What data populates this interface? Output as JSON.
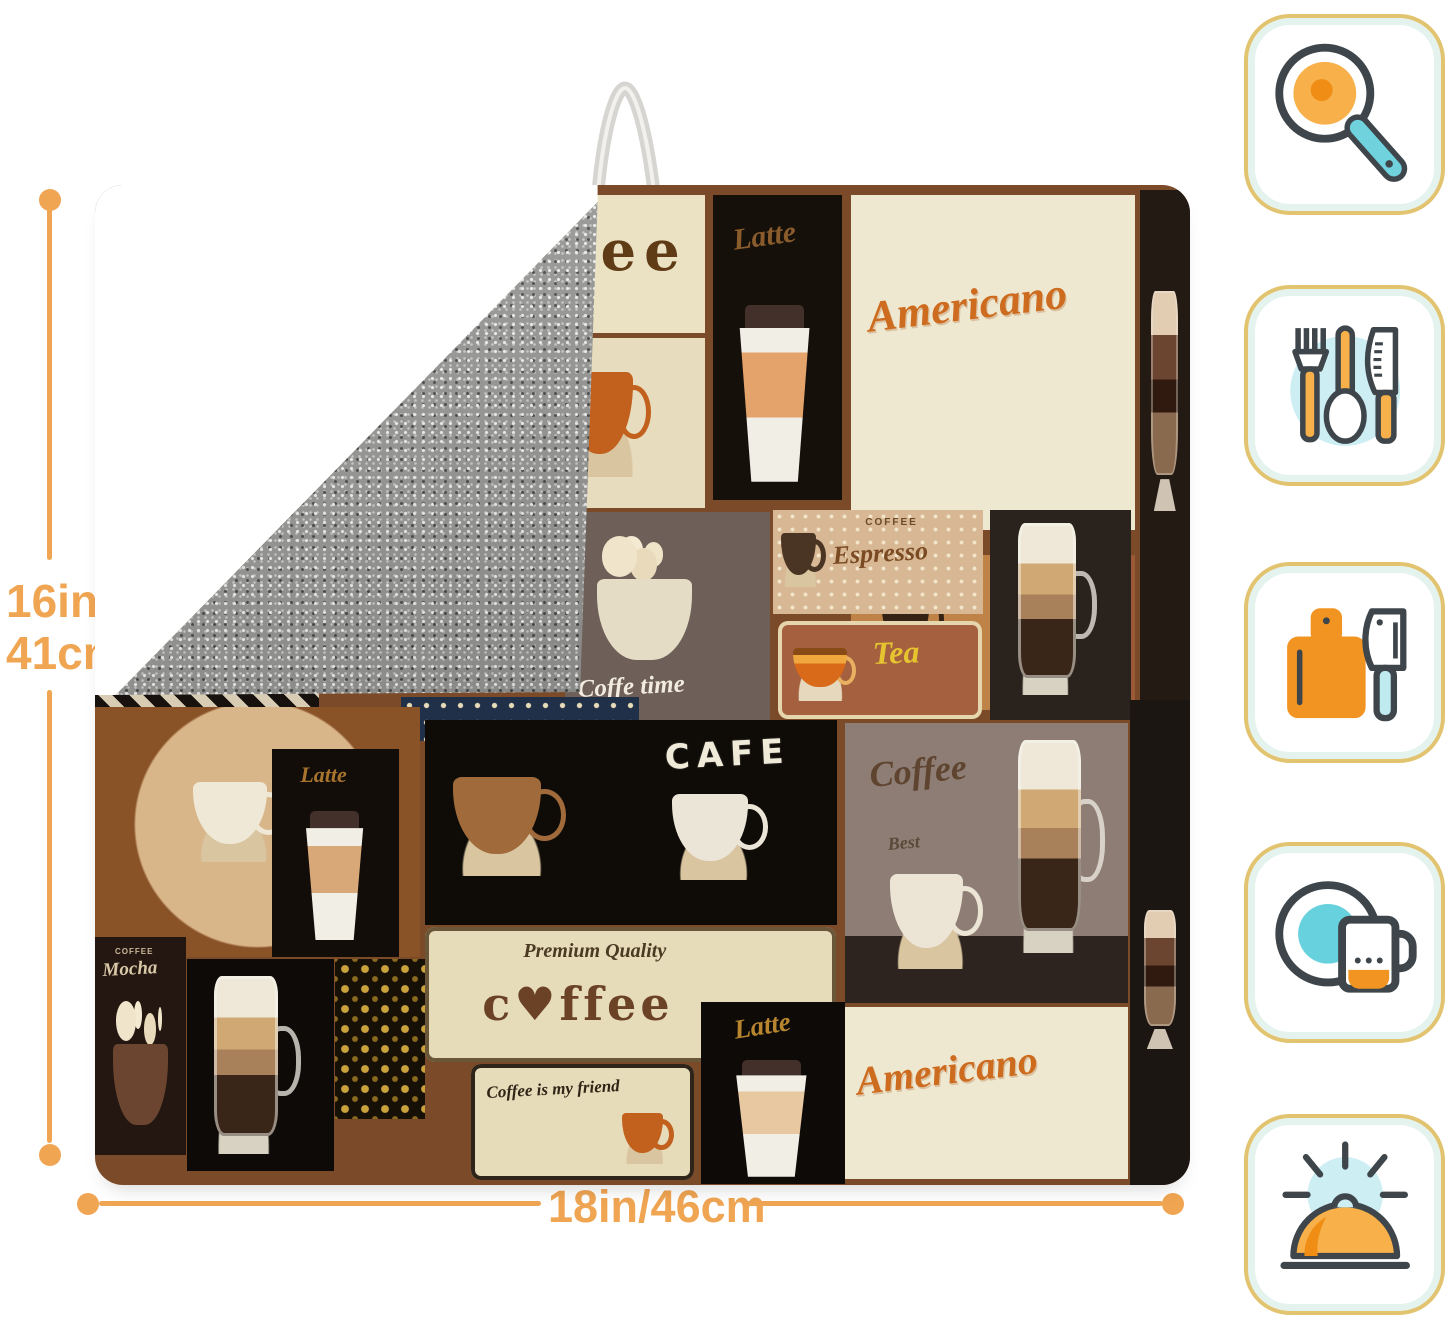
{
  "background": "#ffffff",
  "accent_color": "#f0a552",
  "dimensions": {
    "height_line1": "16in/",
    "height_line2": "41cm",
    "width_label": "18in/46cm"
  },
  "icon_palette": {
    "card_border": "#e2c36f",
    "card_glow": "#e4f3ee",
    "orange": "#f7b04a",
    "orange_dark": "#ef8d14",
    "teal": "#6fd2dd",
    "pale_teal": "#cdeef3",
    "outline": "#3e464b"
  },
  "icons": [
    {
      "name": "frying-pan-icon"
    },
    {
      "name": "cutlery-icon"
    },
    {
      "name": "cutting-board-icon"
    },
    {
      "name": "plate-mug-icon"
    },
    {
      "name": "serving-cloche-icon"
    }
  ],
  "product": {
    "type": "coffee collage dish drying mat",
    "base_color": "#7b4a28",
    "backing_color": "#90908e",
    "loop_color": "#d6d5d1",
    "tiles": [
      {
        "name": "coffee-wordmark",
        "x": 5,
        "y": 1,
        "w": 50.7,
        "h": 13.8,
        "bg": "#ebe2c4",
        "labels": [
          {
            "text": "Coffee",
            "x": 52,
            "y": 20,
            "size": 56,
            "color": "#5f3b16",
            "style": "beans",
            "ls": 8
          }
        ]
      },
      {
        "name": "steaming-cup",
        "x": 13.5,
        "y": 15.3,
        "w": 42.2,
        "h": 17,
        "bg": "#e8dcbe",
        "arts": [
          {
            "type": "cup",
            "color": "#c2601d",
            "x": 70,
            "y": 20,
            "w": 19,
            "h": 62
          }
        ]
      },
      {
        "name": "latte-togo",
        "x": 56.4,
        "y": 1,
        "w": 11.8,
        "h": 30.5,
        "bg": "#16100b",
        "labels": [
          {
            "text": "Latte",
            "x": 14,
            "y": 10,
            "size": 30,
            "color": "#8a5c2c",
            "style": "script",
            "rot": -8
          }
        ],
        "arts": [
          {
            "type": "togo",
            "color": "#e3a36b",
            "x": 18,
            "y": 36,
            "w": 60,
            "h": 58
          }
        ]
      },
      {
        "name": "americano-top",
        "x": 69,
        "y": 1,
        "w": 26,
        "h": 33.5,
        "bg": "#efe8d0",
        "labels": [
          {
            "text": "Americano",
            "x": 5,
            "y": 30,
            "size": 44,
            "color": "#cd6b1f",
            "style": "brush",
            "rot": -7
          }
        ]
      },
      {
        "name": "espresso-glass",
        "x": 69,
        "y": 37,
        "w": 12.8,
        "h": 15.5,
        "bg": "#bf8347",
        "arts": [
          {
            "type": "cup",
            "color": "#342215",
            "x": 22,
            "y": 20,
            "w": 46,
            "h": 55
          }
        ]
      },
      {
        "name": "hot-fresh",
        "x": 82.1,
        "y": 37,
        "w": 12.9,
        "h": 16.5,
        "bg": "#9a5a38",
        "labels": [
          {
            "text": "Coffee",
            "x": 20,
            "y": 6,
            "size": 20,
            "color": "#3d2414",
            "style": "script"
          },
          {
            "text": "hot fresh",
            "x": 12,
            "y": 80,
            "size": 16,
            "color": "#efe2c8",
            "style": "script"
          }
        ],
        "arts": [
          {
            "type": "cup",
            "color": "#ece4d4",
            "x": 26,
            "y": 32,
            "w": 40,
            "h": 40
          }
        ]
      },
      {
        "name": "parfait-strip-top",
        "x": 95.4,
        "y": 0.5,
        "w": 4.6,
        "h": 51,
        "bg": "#241a14",
        "arts": [
          {
            "type": "parfait",
            "color": "#c9a27a",
            "x": 8,
            "y": 18,
            "w": 84,
            "h": 45
          }
        ]
      },
      {
        "name": "coffee-time",
        "x": 42.9,
        "y": 32.7,
        "w": 18.7,
        "h": 21.7,
        "bg": "#6e6058",
        "labels": [
          {
            "text": "Coffe time",
            "x": 6,
            "y": 76,
            "size": 25,
            "color": "#f2ece0",
            "style": "script",
            "rot": -3
          }
        ],
        "arts": [
          {
            "type": "whipped",
            "color": "#e5dcc6",
            "x": 10,
            "y": 10,
            "w": 58,
            "h": 62
          }
        ]
      },
      {
        "name": "espresso-sign",
        "x": 61.9,
        "y": 32.5,
        "w": 19.2,
        "h": 10.4,
        "bg": "#d8b894",
        "pattern": "polka",
        "labels": [
          {
            "text": "COFFEE",
            "x": 44,
            "y": 8,
            "size": 10,
            "color": "#6b4a28",
            "style": "plain",
            "ls": 2
          },
          {
            "text": "Espresso",
            "x": 28,
            "y": 32,
            "size": 26,
            "color": "#7a4a22",
            "style": "script",
            "rot": -3
          }
        ],
        "arts": [
          {
            "type": "cup",
            "color": "#4a3424",
            "x": 4,
            "y": 22,
            "w": 22,
            "h": 52
          }
        ]
      },
      {
        "name": "tea-sign",
        "x": 62.4,
        "y": 43.6,
        "w": 18.6,
        "h": 9.8,
        "bg": "#a5613f",
        "frame": "#e5d6ae",
        "labels": [
          {
            "text": "Tea",
            "x": 46,
            "y": 16,
            "size": 32,
            "color": "#e6c430",
            "style": "script",
            "rot": -2
          }
        ],
        "arts": [
          {
            "type": "teabowl",
            "color": "#e07818",
            "x": 6,
            "y": 16,
            "w": 32,
            "h": 66
          }
        ]
      },
      {
        "name": "latte-glass-mid",
        "x": 81.7,
        "y": 32.5,
        "w": 12.9,
        "h": 21,
        "bg": "#2a221c",
        "arts": [
          {
            "type": "glassmug",
            "color": "#c9a06a",
            "x": 18,
            "y": 6,
            "w": 58,
            "h": 82
          }
        ]
      },
      {
        "name": "bw-diamond-strip",
        "x": 0,
        "y": 50,
        "w": 20.5,
        "h": 3.8,
        "bg": "#17120e",
        "pattern": "diamond-bw"
      },
      {
        "name": "blue-diamond-strip",
        "x": 27.9,
        "y": 51.2,
        "w": 21.8,
        "h": 4.4,
        "bg": "#203049",
        "pattern": "dots-cream"
      },
      {
        "name": "cup-medallion",
        "x": 0,
        "y": 52.2,
        "w": 29.7,
        "h": 25,
        "bg": "#8a5227",
        "pattern": "medallion",
        "arts": [
          {
            "type": "cup",
            "color": "#efe8d6",
            "x": 30,
            "y": 30,
            "w": 30,
            "h": 32
          }
        ]
      },
      {
        "name": "latte-small",
        "x": 16.2,
        "y": 56.4,
        "w": 11.6,
        "h": 20.8,
        "bg": "#120d09",
        "labels": [
          {
            "text": "Latte",
            "x": 22,
            "y": 7,
            "size": 22,
            "color": "#a8742e",
            "style": "script"
          }
        ],
        "arts": [
          {
            "type": "togo",
            "color": "#d8a878",
            "x": 24,
            "y": 30,
            "w": 50,
            "h": 62
          }
        ]
      },
      {
        "name": "cafe-board",
        "x": 30.1,
        "y": 53.5,
        "w": 37.7,
        "h": 20.5,
        "bg": "#0f0c08",
        "labels": [
          {
            "text": "CAFE",
            "x": 58,
            "y": 10,
            "size": 34,
            "color": "#f0ead8",
            "style": "chalk",
            "ls": 7,
            "rot": -3
          }
        ],
        "arts": [
          {
            "type": "cup",
            "color": "#a06a3a",
            "x": 7,
            "y": 28,
            "w": 28,
            "h": 48
          },
          {
            "type": "cup",
            "color": "#ebe5d7",
            "x": 60,
            "y": 36,
            "w": 24,
            "h": 42
          }
        ]
      },
      {
        "name": "premium-quality",
        "x": 30.1,
        "y": 74.2,
        "w": 37.6,
        "h": 13.5,
        "bg": "#e6dcba",
        "frame": "#6a5638",
        "labels": [
          {
            "text": "Premium Quality",
            "x": 24,
            "y": 10,
            "size": 20,
            "color": "#4a3a22",
            "style": "script"
          },
          {
            "text": "c♥ffee",
            "x": 14,
            "y": 40,
            "size": 46,
            "color": "#6b4226",
            "style": "beans",
            "ls": 4
          }
        ]
      },
      {
        "name": "gold-ornament",
        "x": 21.9,
        "y": 77.4,
        "w": 8.2,
        "h": 16,
        "bg": "#171007",
        "pattern": "gold"
      },
      {
        "name": "mocha",
        "x": 0,
        "y": 75.2,
        "w": 8.3,
        "h": 21.8,
        "bg": "#241711",
        "labels": [
          {
            "text": "COFFEE",
            "x": 22,
            "y": 5,
            "size": 8,
            "color": "#cbb89a",
            "style": "plain",
            "ls": 1
          },
          {
            "text": "Mocha",
            "x": 8,
            "y": 11,
            "size": 19,
            "color": "#d8c8a8",
            "style": "script",
            "rot": -3
          }
        ],
        "arts": [
          {
            "type": "whipped",
            "color": "#6b4530",
            "x": 12,
            "y": 28,
            "w": 76,
            "h": 62
          }
        ]
      },
      {
        "name": "latte-glass-bottomleft",
        "x": 8.4,
        "y": 77.4,
        "w": 13.4,
        "h": 21.2,
        "bg": "#0d0a07",
        "arts": [
          {
            "type": "glassmug",
            "color": "#c9a06a",
            "x": 16,
            "y": 8,
            "w": 62,
            "h": 84
          }
        ]
      },
      {
        "name": "coffee-friend",
        "x": 34.3,
        "y": 87.9,
        "w": 20.4,
        "h": 11.6,
        "bg": "#e6dcba",
        "frame": "#2e241a",
        "labels": [
          {
            "text": "Coffee is my friend",
            "x": 7,
            "y": 16,
            "size": 17,
            "color": "#2f2416",
            "style": "script",
            "rot": -3,
            "w": 62
          }
        ],
        "arts": [
          {
            "type": "cup",
            "color": "#c2601d",
            "x": 68,
            "y": 42,
            "w": 24,
            "h": 44
          }
        ]
      },
      {
        "name": "latte-gold",
        "x": 55.3,
        "y": 81.7,
        "w": 13.2,
        "h": 18.2,
        "bg": "#0d0a07",
        "labels": [
          {
            "text": "Latte",
            "x": 22,
            "y": 8,
            "size": 27,
            "color": "#b8862e",
            "style": "script",
            "rot": -9
          }
        ],
        "arts": [
          {
            "type": "togo",
            "color": "#e8c8a0",
            "x": 22,
            "y": 32,
            "w": 54,
            "h": 64
          }
        ]
      },
      {
        "name": "coffee-best",
        "x": 68.5,
        "y": 53.8,
        "w": 25.8,
        "h": 28,
        "bg": "#8d7d74",
        "pattern": "duotone",
        "labels": [
          {
            "text": "Coffee",
            "x": 8,
            "y": 12,
            "size": 36,
            "color": "#5f4430",
            "style": "script",
            "rot": -5
          },
          {
            "text": "Best",
            "x": 15,
            "y": 40,
            "size": 18,
            "color": "#5a4a3a",
            "style": "script",
            "rot": -5
          }
        ],
        "arts": [
          {
            "type": "glassmug",
            "color": "#c9a06a",
            "x": 60,
            "y": 6,
            "w": 32,
            "h": 76
          },
          {
            "type": "cup",
            "color": "#ece4d4",
            "x": 16,
            "y": 54,
            "w": 34,
            "h": 34
          }
        ]
      },
      {
        "name": "americano-bottom",
        "x": 68.5,
        "y": 82.2,
        "w": 25.8,
        "h": 17.2,
        "bg": "#efe8d0",
        "labels": [
          {
            "text": "Americano",
            "x": 3,
            "y": 32,
            "size": 40,
            "color": "#cd6b1f",
            "style": "brush",
            "rot": -7
          }
        ]
      },
      {
        "name": "parfait-strip-bottom",
        "x": 94.5,
        "y": 51.5,
        "w": 5.5,
        "h": 48.5,
        "bg": "#1c1612",
        "arts": [
          {
            "type": "parfait",
            "color": "#c9a27a",
            "x": 8,
            "y": 42,
            "w": 84,
            "h": 30
          }
        ]
      }
    ]
  }
}
